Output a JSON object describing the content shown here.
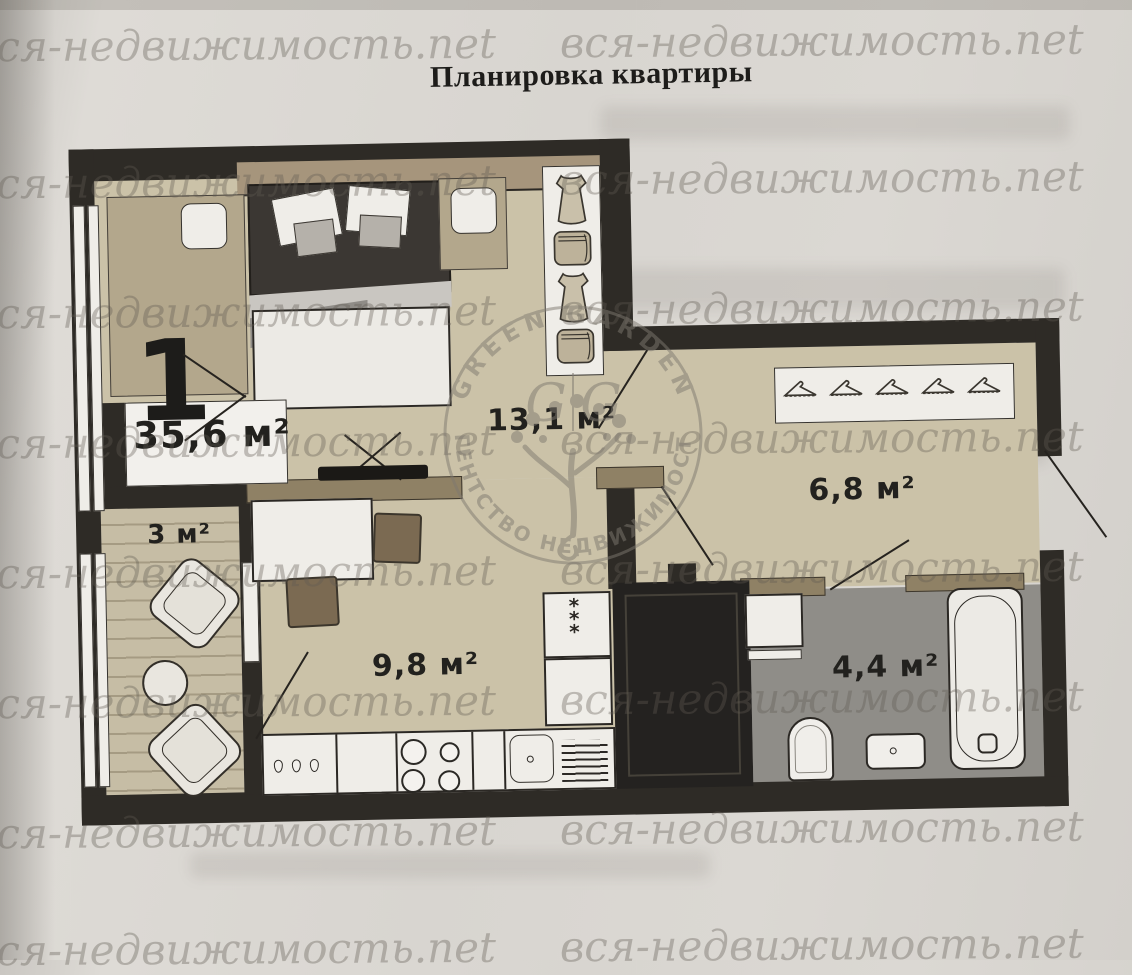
{
  "page": {
    "title": "Планировка квартиры"
  },
  "watermark": {
    "text": "вся-недвижимость.net"
  },
  "stamp": {
    "arc_top": "GREEN GARDEN",
    "arc_bottom": "АГЕНТСТВО НЕДВИЖИМОСТИ",
    "monogram_left": "G",
    "monogram_right": "G"
  },
  "apartment": {
    "number": "1",
    "total_area": "35,6 м²"
  },
  "rooms": {
    "living_room": {
      "area": "13,1 м²"
    },
    "hallway": {
      "area": "6,8 м²"
    },
    "kitchen": {
      "area": "9,8 м²"
    },
    "balcony": {
      "area": "3 м²"
    },
    "bathroom": {
      "area": "4,4 м²"
    }
  },
  "icons": {
    "freezer_marks": "*\n*\n*"
  },
  "colors": {
    "wall": "#2e2b26",
    "floor": "#cbc2a8",
    "bathroom_floor": "#8f8d88",
    "partition": "#8f8165",
    "paper": "#d9d6d1",
    "storage": "#242220",
    "watermark": "#8e897f",
    "label": "#22211e"
  }
}
